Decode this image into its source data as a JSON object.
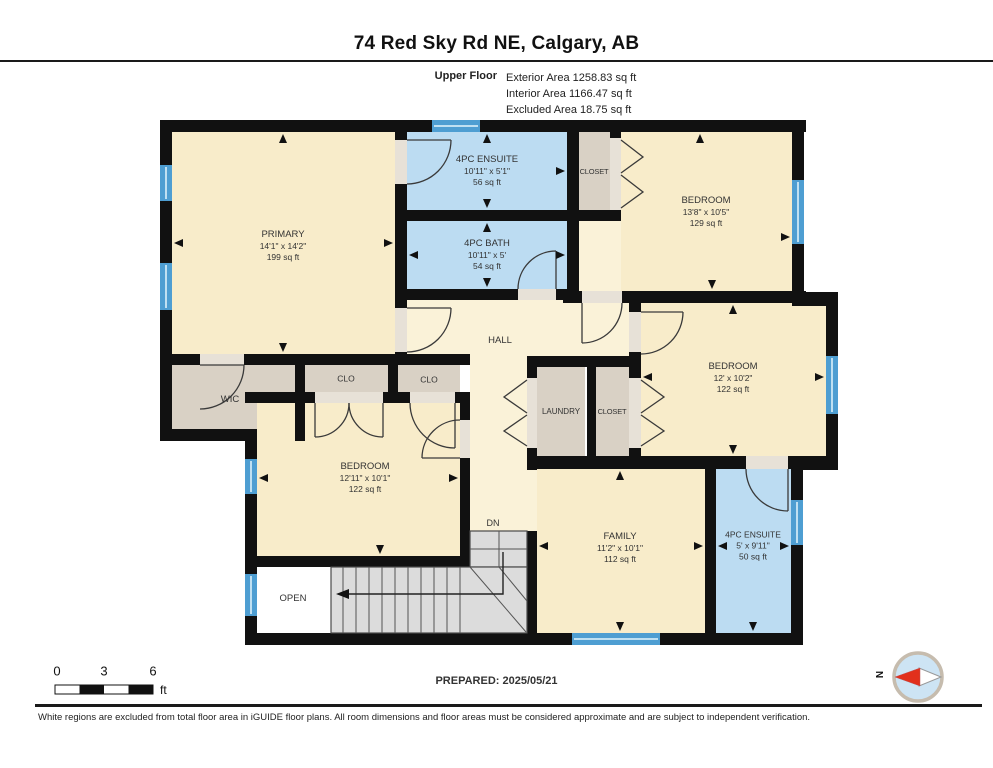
{
  "header": {
    "address": "74 Red Sky Rd NE, Calgary, AB",
    "floor_label": "Upper Floor",
    "areas": [
      "Exterior Area 1258.83 sq ft",
      "Interior Area 1166.47 sq ft",
      "Excluded Area 18.75 sq ft"
    ]
  },
  "rooms": {
    "primary": {
      "name": "PRIMARY",
      "dims": "14'1\" x 14'2\"",
      "area": "199 sq ft"
    },
    "ensuite_top": {
      "name": "4PC ENSUITE",
      "dims": "10'11\" x 5'1\"",
      "area": "56 sq ft"
    },
    "closet_top": {
      "name": "CLOSET"
    },
    "bedroom_ne": {
      "name": "BEDROOM",
      "dims": "13'8\" x 10'5\"",
      "area": "129 sq ft"
    },
    "bath": {
      "name": "4PC BATH",
      "dims": "10'11\" x 5'",
      "area": "54 sq ft"
    },
    "hall": {
      "name": "HALL"
    },
    "bedroom_e": {
      "name": "BEDROOM",
      "dims": "12' x 10'2\"",
      "area": "122 sq ft"
    },
    "wic": {
      "name": "WIC"
    },
    "clo_left": {
      "name": "CLO"
    },
    "clo_right": {
      "name": "CLO"
    },
    "laundry": {
      "name": "LAUNDRY"
    },
    "closet_mid": {
      "name": "CLOSET"
    },
    "bedroom_sw": {
      "name": "BEDROOM",
      "dims": "12'11\" x 10'1\"",
      "area": "122 sq ft"
    },
    "family": {
      "name": "FAMILY",
      "dims": "11'2\" x 10'1\"",
      "area": "112 sq ft"
    },
    "ensuite_se": {
      "name": "4PC ENSUITE",
      "dims": "5' x 9'11\"",
      "area": "50 sq ft"
    },
    "open": {
      "name": "OPEN"
    },
    "stairs": {
      "label": "DN"
    }
  },
  "footer": {
    "scale": {
      "ticks": [
        "0",
        "3",
        "6"
      ],
      "unit": "ft"
    },
    "prepared": "PREPARED: 2025/05/21",
    "compass": {
      "label": "N"
    },
    "disclaimer": "White regions are excluded from total floor area in iGUIDE floor plans. All room dimensions and floor areas must be considered approximate and are subject to independent verification."
  },
  "colors": {
    "wall": "#111111",
    "room_fill": "#f8ecca",
    "hall_fill": "#faf2d8",
    "wet_room_fill": "#bcdcf2",
    "closet_fill": "#d9d1c5",
    "stair_fill": "#dcdcdc",
    "window_blue": "#4e9ed2",
    "excluded_white": "#ffffff",
    "compass_needle_red": "#e2301c"
  }
}
